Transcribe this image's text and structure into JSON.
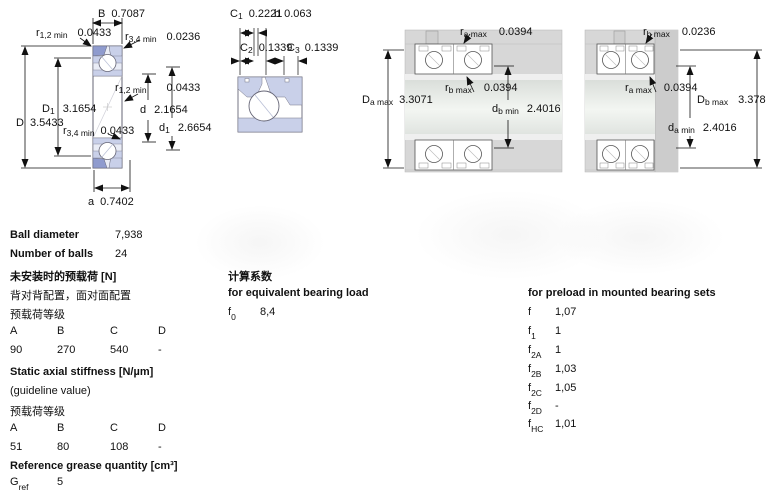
{
  "diagram1": {
    "B": {
      "sym": "B",
      "sub": "",
      "val": "0.7087"
    },
    "r12_top": {
      "sym": "r",
      "sub": "1,2 min",
      "val": "0.0433"
    },
    "r34_top": {
      "sym": "r",
      "sub": "3,4 min",
      "val": "0.0236"
    },
    "r12_inner": {
      "sym": "r",
      "sub": "1,2 min",
      "val": "0.0433"
    },
    "D1": {
      "sym": "D",
      "sub": "1",
      "val": "3.1654"
    },
    "d": {
      "sym": "d",
      "sub": "",
      "val": "2.1654"
    },
    "D": {
      "sym": "D",
      "sub": "",
      "val": "3.5433"
    },
    "r34_inner": {
      "sym": "r",
      "sub": "3,4 min",
      "val": "0.0433"
    },
    "d1": {
      "sym": "d",
      "sub": "1",
      "val": "2.6654"
    },
    "a": {
      "sym": "a",
      "sub": "",
      "val": "0.7402"
    }
  },
  "diagram2": {
    "C1": {
      "sym": "C",
      "sub": "1",
      "val": "0.2221"
    },
    "b": {
      "sym": "b",
      "sub": "",
      "val": "0.063"
    },
    "C2": {
      "sym": "C",
      "sub": "2",
      "val": "0.1339"
    },
    "C3": {
      "sym": "C",
      "sub": "3",
      "val": "0.1339"
    }
  },
  "diagram3": {
    "ra_max": {
      "sym": "r",
      "sub": "a max",
      "val": "0.0394"
    },
    "rb_max": {
      "sym": "r",
      "sub": "b max",
      "val": "0.0394"
    },
    "Da_max": {
      "sym": "D",
      "sub": "a max",
      "val": "3.3071"
    },
    "db_min": {
      "sym": "d",
      "sub": "b min",
      "val": "2.4016"
    }
  },
  "diagram4": {
    "rb_max": {
      "sym": "r",
      "sub": "b max",
      "val": "0.0236"
    },
    "ra_max": {
      "sym": "r",
      "sub": "a max",
      "val": "0.0394"
    },
    "Db_max": {
      "sym": "D",
      "sub": "b max",
      "val": "3.378"
    },
    "da_min": {
      "sym": "d",
      "sub": "a min",
      "val": "2.4016"
    }
  },
  "specs": {
    "ball_diameter_label": "Ball diameter",
    "ball_diameter_value": "7,938",
    "number_of_balls_label": "Number of balls",
    "number_of_balls_value": "24"
  },
  "preload": {
    "title": "未安装时的预载荷 [N]",
    "subtitle": "背对背配置，面对面配置",
    "class_label": "预载荷等级",
    "cols": [
      "A",
      "B",
      "C",
      "D"
    ],
    "values": [
      "90",
      "270",
      "540",
      "-"
    ]
  },
  "stiffness": {
    "title": "Static axial stiffness [N/µm]",
    "subtitle": "(guideline value)",
    "class_label": "预载荷等级",
    "cols": [
      "A",
      "B",
      "C",
      "D"
    ],
    "values": [
      "51",
      "80",
      "108",
      "-"
    ]
  },
  "grease": {
    "title": "Reference grease quantity [cm³]",
    "sym": "G",
    "sub": "ref",
    "value": "5"
  },
  "calc_factors": {
    "title": "计算系数",
    "subtitle": "for equivalent bearing load",
    "f0": {
      "sym": "f",
      "sub": "0",
      "val": "8,4"
    }
  },
  "preload_factors": {
    "title": "for preload in mounted bearing sets",
    "rows": [
      {
        "sym": "f",
        "sub": "",
        "val": "1,07"
      },
      {
        "sym": "f",
        "sub": "1",
        "val": "1"
      },
      {
        "sym": "f",
        "sub": "2A",
        "val": "1"
      },
      {
        "sym": "f",
        "sub": "2B",
        "val": "1,03"
      },
      {
        "sym": "f",
        "sub": "2C",
        "val": "1,05"
      },
      {
        "sym": "f",
        "sub": "2D",
        "val": "-"
      },
      {
        "sym": "f",
        "sub": "HC",
        "val": "1,01"
      }
    ]
  }
}
